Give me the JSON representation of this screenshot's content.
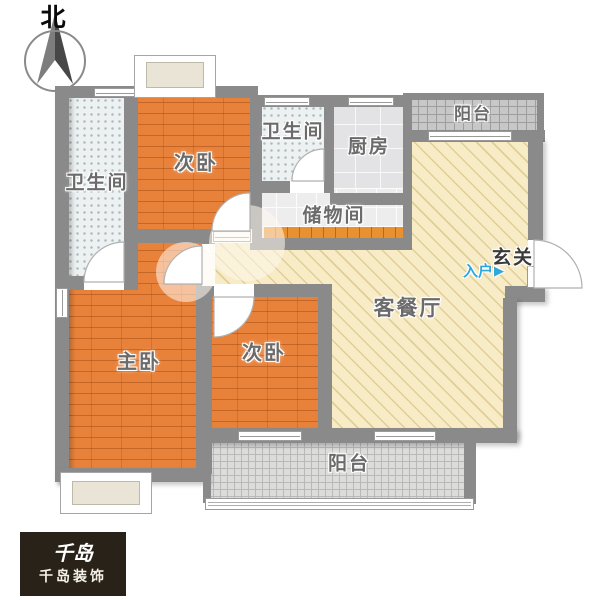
{
  "compass": {
    "north_label": "北"
  },
  "rooms": {
    "bathroom_left": {
      "label": "卫生间"
    },
    "bedroom_top": {
      "label": "次卧"
    },
    "bathroom_mid": {
      "label": "卫生间"
    },
    "kitchen": {
      "label": "厨房"
    },
    "storage": {
      "label": "储物间"
    },
    "balcony_top": {
      "label": "阳台"
    },
    "living_dining": {
      "label": "客餐厅"
    },
    "master_bedroom": {
      "label": "主卧"
    },
    "bedroom_bottom": {
      "label": "次卧"
    },
    "balcony_bottom": {
      "label": "阳台"
    },
    "entry": {
      "hall_label": "玄关",
      "entry_label": "入户",
      "arrow_glyph": "▶"
    }
  },
  "branding": {
    "logo_mark": "千岛",
    "logo_name": "千岛装饰"
  },
  "colors": {
    "wall": "#8a8a8a",
    "wood_floor": "#e8823b",
    "living_floor": "#f7ecc6",
    "bath_tile": "#edf1f1",
    "kitchen_tile": "#e3e3e5",
    "balcony_tile": "#c7c7c7",
    "entry_blue": "#2ea7dc",
    "logo_bg": "#282219"
  }
}
